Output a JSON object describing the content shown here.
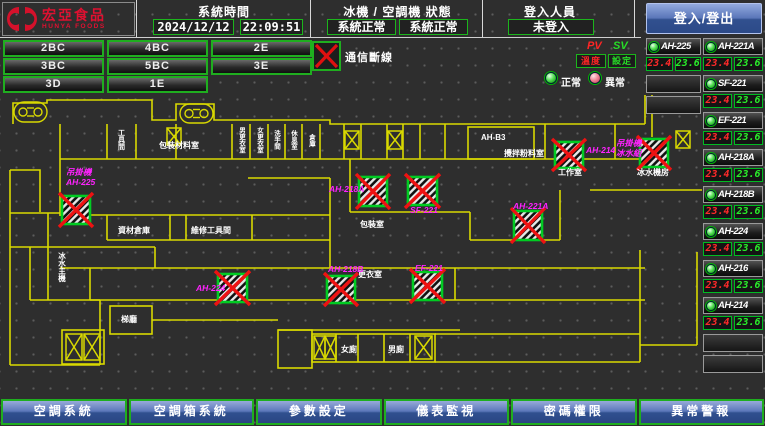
{
  "header": {
    "logo_title": "宏亞食品",
    "logo_subtitle": "HUNYA FOODS",
    "system_time_label": "系統時間",
    "date": "2024/12/12",
    "time": "22:09:51",
    "machine_status_label": "冰機 / 空調機 狀態",
    "machine_status_1": "系統正常",
    "machine_status_2": "系統正常",
    "login_label": "登入人員",
    "login_status": "未登入",
    "login_button_label": "登入/登出"
  },
  "floor_buttons": [
    {
      "label": "2BC",
      "row": 0,
      "col": 0
    },
    {
      "label": "4BC",
      "row": 0,
      "col": 1
    },
    {
      "label": "2E",
      "row": 0,
      "col": 2
    },
    {
      "label": "3BC",
      "row": 1,
      "col": 0
    },
    {
      "label": "5BC",
      "row": 1,
      "col": 1
    },
    {
      "label": "3E",
      "row": 1,
      "col": 2
    },
    {
      "label": "3D",
      "row": 2,
      "col": 0
    },
    {
      "label": "1E",
      "row": 2,
      "col": 1
    }
  ],
  "comm_alarm": {
    "label": "通信斷線"
  },
  "value_columns": {
    "pv_label": "PV",
    "sv_label": "SV",
    "pv_sub": "溫度",
    "sv_sub": "設定"
  },
  "legend": {
    "normal": "正常",
    "abnormal": "異常"
  },
  "equipment_left": [
    {
      "name": "AH-225",
      "pv": "23.4",
      "sv": "23.6",
      "status": "normal"
    }
  ],
  "equipment_left_empty_rows": 2,
  "equipment_right": [
    {
      "name": "AH-221A",
      "pv": "23.4",
      "sv": "23.6",
      "status": "normal"
    },
    {
      "name": "SF-221",
      "pv": "23.4",
      "sv": "23.6",
      "status": "normal"
    },
    {
      "name": "EF-221",
      "pv": "23.4",
      "sv": "23.6",
      "status": "normal"
    },
    {
      "name": "AH-218A",
      "pv": "23.4",
      "sv": "23.6",
      "status": "normal"
    },
    {
      "name": "AH-218B",
      "pv": "23.4",
      "sv": "23.6",
      "status": "normal"
    },
    {
      "name": "AH-224",
      "pv": "23.4",
      "sv": "23.6",
      "status": "normal"
    },
    {
      "name": "AH-216",
      "pv": "23.4",
      "sv": "23.6",
      "status": "normal"
    },
    {
      "name": "AH-214",
      "pv": "23.4",
      "sv": "23.6",
      "status": "normal"
    }
  ],
  "equipment_right_empty_rows": 2,
  "map": {
    "colors": {
      "wall": "#d9d900",
      "device_label": "#ff22ff",
      "room_label": "#ffffff",
      "fault_red": "#ee1212",
      "fault_green": "#00cc22"
    },
    "room_labels": [
      {
        "text": "工具間",
        "x": 121,
        "y": 129,
        "vertical": true,
        "size": 7
      },
      {
        "text": "包裝材料室",
        "x": 159,
        "y": 148,
        "size": 8
      },
      {
        "text": "男更衣室",
        "x": 241,
        "y": 127,
        "vertical": true,
        "size": 6.5
      },
      {
        "text": "女更衣室",
        "x": 259,
        "y": 127,
        "vertical": true,
        "size": 6.5
      },
      {
        "text": "洗手間",
        "x": 276,
        "y": 130,
        "vertical": true,
        "size": 6.5
      },
      {
        "text": "休息室",
        "x": 293,
        "y": 130,
        "vertical": true,
        "size": 6.5
      },
      {
        "text": "倉庫",
        "x": 311,
        "y": 134,
        "vertical": true,
        "size": 6.5
      },
      {
        "text": "AH-B3",
        "x": 481,
        "y": 140,
        "size": 8
      },
      {
        "text": "攪拌粉料室",
        "x": 504,
        "y": 156,
        "size": 8
      },
      {
        "text": "工作室",
        "x": 558,
        "y": 175,
        "size": 8
      },
      {
        "text": "冰水機房",
        "x": 637,
        "y": 175,
        "size": 8
      },
      {
        "text": "資材倉庫",
        "x": 118,
        "y": 233,
        "size": 8
      },
      {
        "text": "維修工具間",
        "x": 191,
        "y": 233,
        "size": 8
      },
      {
        "text": "包裝室",
        "x": 360,
        "y": 227,
        "size": 8
      },
      {
        "text": "更衣室",
        "x": 358,
        "y": 277,
        "size": 8
      },
      {
        "text": "冰水主機",
        "x": 62,
        "y": 252,
        "vertical": true,
        "size": 7.5
      },
      {
        "text": "梯廳",
        "x": 121,
        "y": 322,
        "size": 8
      },
      {
        "text": "女廁",
        "x": 341,
        "y": 352,
        "size": 8
      },
      {
        "text": "男廁",
        "x": 388,
        "y": 352,
        "size": 8
      }
    ],
    "device_labels": [
      {
        "lines": [
          "吊掛機",
          "AH-225"
        ],
        "x": 66,
        "y": 175
      },
      {
        "lines": [
          "AH-218A"
        ],
        "x": 329,
        "y": 192
      },
      {
        "lines": [
          "SF-221"
        ],
        "x": 410,
        "y": 213
      },
      {
        "lines": [
          "AH-214"
        ],
        "x": 586,
        "y": 153
      },
      {
        "lines": [
          "吊掛機",
          "冰水組"
        ],
        "x": 616,
        "y": 146
      },
      {
        "lines": [
          "AH-221A"
        ],
        "x": 513,
        "y": 209
      },
      {
        "lines": [
          "AH-224"
        ],
        "x": 196,
        "y": 291
      },
      {
        "lines": [
          "AH-218B"
        ],
        "x": 328,
        "y": 272
      },
      {
        "lines": [
          "EF-221"
        ],
        "x": 415,
        "y": 271
      }
    ],
    "fault_icons": [
      {
        "x": 62,
        "y": 196,
        "w": 28,
        "h": 28
      },
      {
        "x": 359,
        "y": 177,
        "w": 28,
        "h": 29
      },
      {
        "x": 408,
        "y": 177,
        "w": 29,
        "h": 28
      },
      {
        "x": 555,
        "y": 142,
        "w": 28,
        "h": 26
      },
      {
        "x": 640,
        "y": 139,
        "w": 28,
        "h": 28
      },
      {
        "x": 514,
        "y": 211,
        "w": 28,
        "h": 29
      },
      {
        "x": 218,
        "y": 274,
        "w": 29,
        "h": 28
      },
      {
        "x": 327,
        "y": 276,
        "w": 28,
        "h": 27
      },
      {
        "x": 413,
        "y": 272,
        "w": 29,
        "h": 28
      }
    ],
    "x_boxes": [
      {
        "x": 167,
        "y": 128,
        "w": 14,
        "h": 17
      },
      {
        "x": 345,
        "y": 131,
        "w": 14,
        "h": 18
      },
      {
        "x": 388,
        "y": 131,
        "w": 14,
        "h": 18
      },
      {
        "x": 676,
        "y": 131,
        "w": 14,
        "h": 17
      },
      {
        "x": 66,
        "y": 334,
        "w": 16,
        "h": 26
      },
      {
        "x": 84,
        "y": 334,
        "w": 16,
        "h": 26
      },
      {
        "x": 314,
        "y": 336,
        "w": 11,
        "h": 23
      },
      {
        "x": 325,
        "y": 336,
        "w": 11,
        "h": 23
      },
      {
        "x": 415,
        "y": 336,
        "w": 17,
        "h": 23
      }
    ],
    "stairs": [
      {
        "x": 14,
        "y": 102,
        "w": 33,
        "h": 20
      },
      {
        "x": 180,
        "y": 104,
        "w": 33,
        "h": 19
      }
    ]
  },
  "bottom_menu": [
    {
      "label": "空調系統"
    },
    {
      "label": "空調箱系統"
    },
    {
      "label": "參數設定"
    },
    {
      "label": "儀表監視"
    },
    {
      "label": "密碼權限"
    },
    {
      "label": "異常警報"
    }
  ]
}
